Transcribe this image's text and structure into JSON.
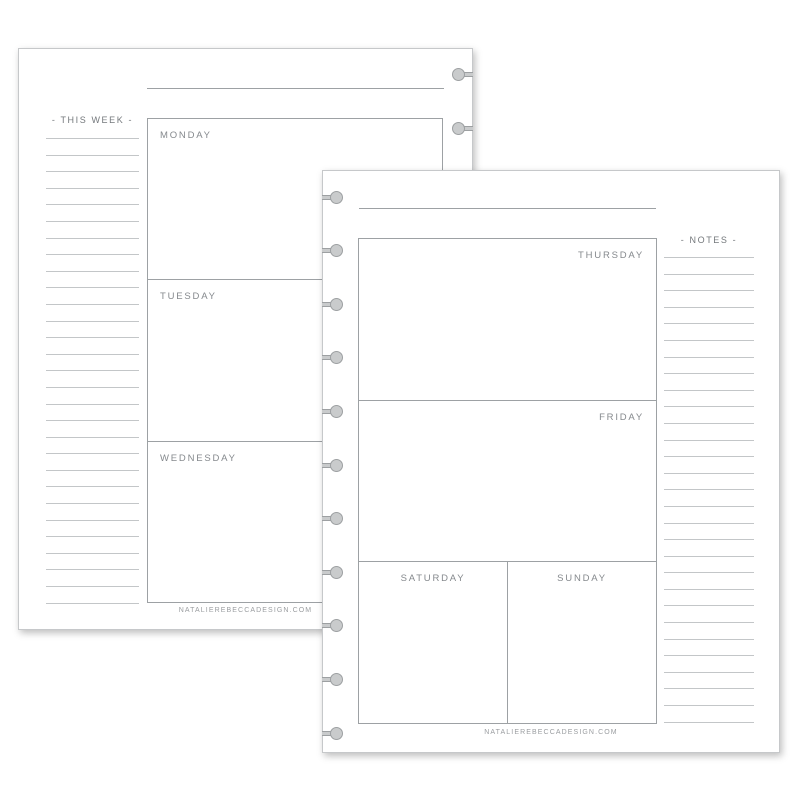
{
  "back_page": {
    "heading": "- THIS WEEK -",
    "days": [
      "MONDAY",
      "TUESDAY",
      "WEDNESDAY"
    ],
    "footer": "NATALIEREBECCADESIGN.COM",
    "ruled_line_count": 29,
    "punch_hole_count": 11
  },
  "front_page": {
    "heading": "- NOTES -",
    "days": [
      "THURSDAY",
      "FRIDAY",
      "SATURDAY",
      "SUNDAY"
    ],
    "footer": "NATALIEREBECCADESIGN.COM",
    "ruled_line_count": 29,
    "punch_hole_count": 11
  },
  "colors": {
    "canvas_bg": "#ffffff",
    "page_bg": "#ffffff",
    "page_border": "#c6c8ca",
    "box_border": "#9da1a4",
    "rule_line": "#c3c6c8",
    "label_text": "#85898d",
    "heading_text": "#74787c",
    "footer_text": "#9a9da0",
    "disc_fill": "#c9cbcc",
    "disc_border": "#9da0a2"
  }
}
